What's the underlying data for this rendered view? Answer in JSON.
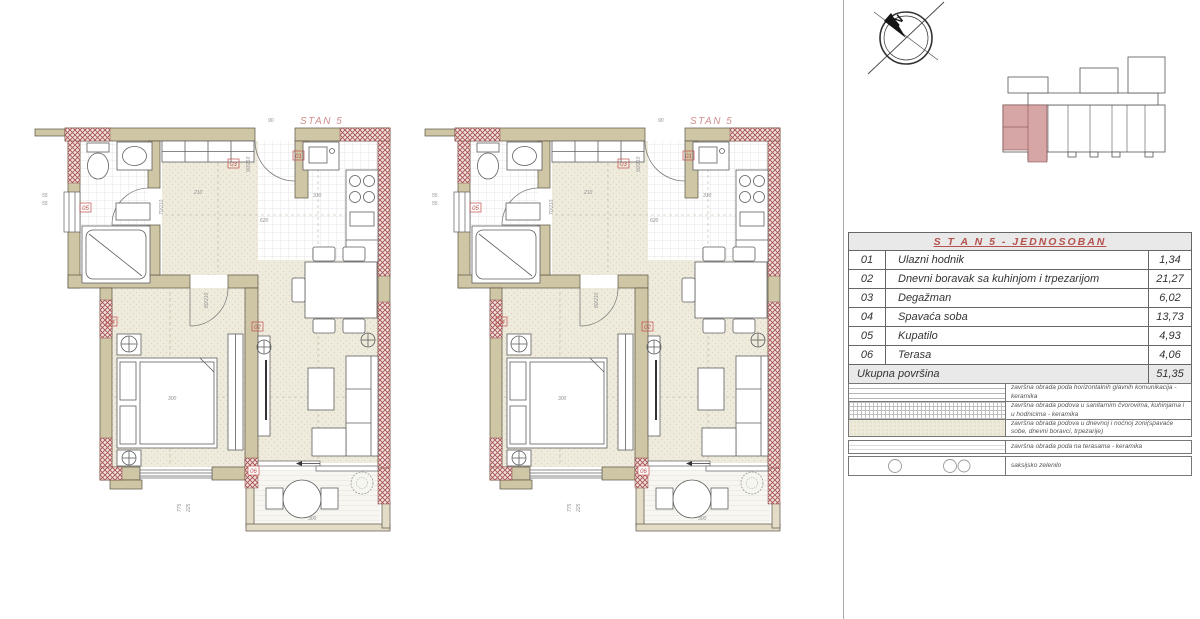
{
  "drawing": {
    "plan_label": "STAN 5",
    "north_label": "N",
    "markers": {
      "m01": "01",
      "m02": "02",
      "m03": "03",
      "m04": "04",
      "m05": "05",
      "m06": "06"
    },
    "dims": {
      "d1": "55",
      "d2": "55",
      "d3": "210",
      "d4": "310",
      "d5": "620",
      "d6": "300",
      "d7": "775",
      "d8": "225",
      "d9": "300",
      "d10": "90",
      "door_bath": "70/210",
      "door_entry": "90/210",
      "door_bed": "80/210"
    }
  },
  "table": {
    "title": "S T A N  5 - JEDNOSOBAN",
    "rows": [
      {
        "no": "01",
        "name": "Ulazni hodnik",
        "area": "1,34"
      },
      {
        "no": "02",
        "name": "Dnevni boravak sa kuhinjom i trpezarijom",
        "area": "21,27"
      },
      {
        "no": "03",
        "name": "Degažman",
        "area": "6,02"
      },
      {
        "no": "04",
        "name": "Spavaća soba",
        "area": "13,73"
      },
      {
        "no": "05",
        "name": "Kupatilo",
        "area": "4,93"
      },
      {
        "no": "06",
        "name": "Terasa",
        "area": "4,06"
      }
    ],
    "total_label": "Ukupna površina",
    "total_value": "51,35"
  },
  "legend": {
    "rows": [
      {
        "swatch": "horizontal-lines",
        "text": "završna obrada poda horizontalnih glavnih komunikacija - keramika"
      },
      {
        "swatch": "tile-grid",
        "text": "završna obrada podova u sanitarnim čvorovima, kuhinjama i u hodnicima - keramika"
      },
      {
        "swatch": "beige-dots",
        "text": "završna obrada podova u dnevnoj i noćnoj zoni(spavaće sobe, dnevni boravci, trpezarije)"
      },
      {
        "swatch": "terrace-lines",
        "text": "završna obrada poda na terasama - keramika"
      },
      {
        "swatch": "plant-circles",
        "text": "saksijsko zelenilo"
      }
    ]
  },
  "colors": {
    "accent_red": "#bf4e4a",
    "plan_label_pink": "#d08f8f",
    "wall_beige": "#cfc6a6",
    "floor_cream": "#edeadc",
    "keyplan_pink": "#d6a5a5",
    "header_bg": "#e9e9e9"
  }
}
